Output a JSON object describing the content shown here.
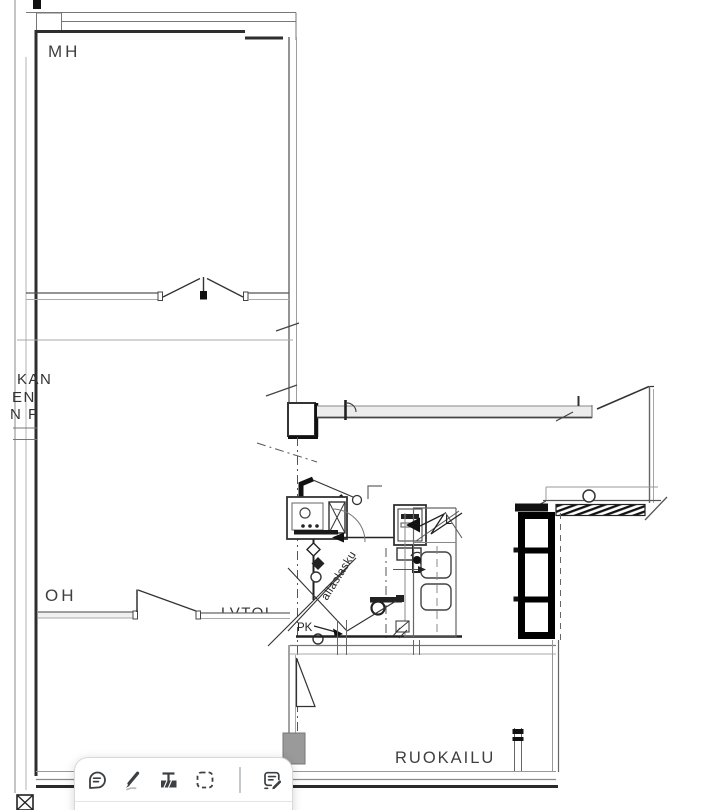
{
  "viewer": {
    "background": "#ffffff"
  },
  "plan": {
    "line_color": "#3f3f3f",
    "rooms": {
      "mh": "MH",
      "oh": "OH",
      "ruokailu": "RUOKAILU"
    },
    "labels": {
      "wall_text": "LVTOI",
      "counter": "L",
      "pk": "PK",
      "drain_diagonal": "allaslasku"
    },
    "edge_text_fragments": [
      "KAN",
      "EN",
      "N F"
    ]
  },
  "toolbar": {
    "background": "#ffffff",
    "icon_color": "#3c4043",
    "icons": [
      {
        "name": "comment-icon"
      },
      {
        "name": "highlighter-pen-icon"
      },
      {
        "name": "text-highlight-icon"
      },
      {
        "name": "selection-capture-icon"
      },
      {
        "name": "note-edit-icon"
      }
    ]
  }
}
